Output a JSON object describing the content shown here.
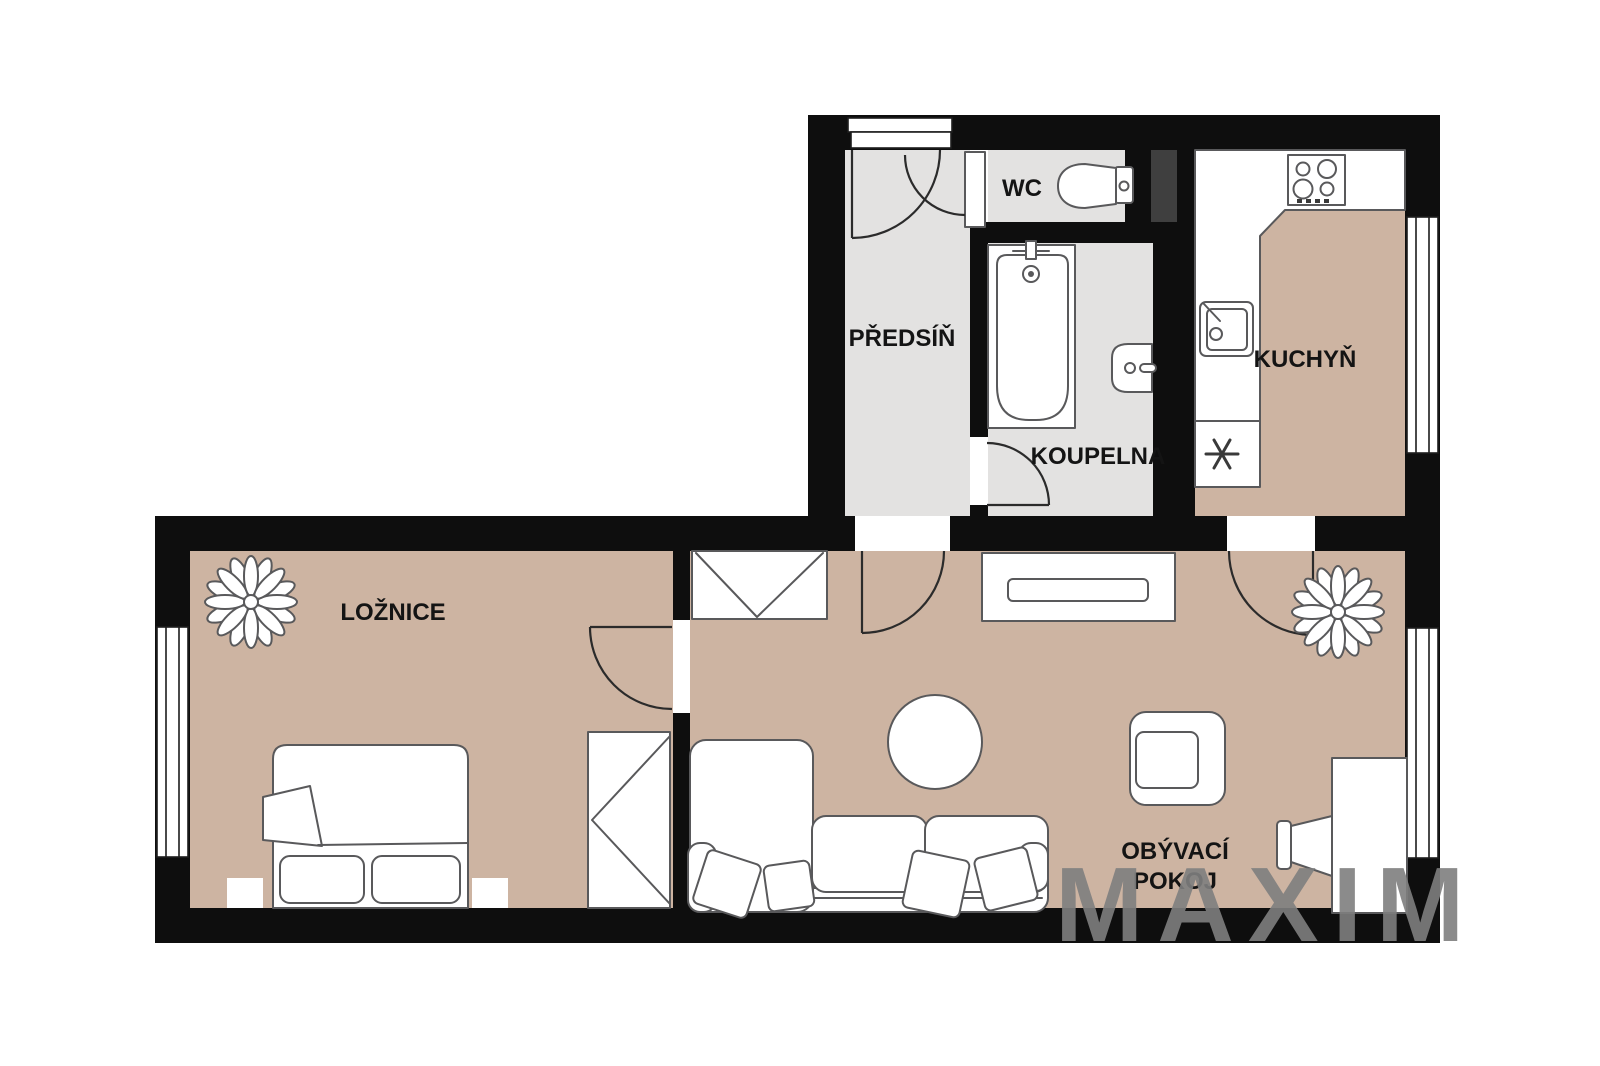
{
  "floorplan": {
    "watermark": "MAXIM",
    "rooms": {
      "hallway": {
        "label": "PŘEDSÍŇ"
      },
      "wc": {
        "label": "WC"
      },
      "bathroom": {
        "label": "KOUPELNA"
      },
      "kitchen": {
        "label": "KUCHYŇ"
      },
      "bedroom": {
        "label": "LOŽNICE"
      },
      "living_room": {
        "label_line1": "OBÝVACÍ",
        "label_line2": "POKOJ"
      }
    },
    "fixtures": [
      "entrance-door",
      "toilet",
      "bathtub",
      "bathroom-sink",
      "stove",
      "kitchen-sink",
      "freezer",
      "bed",
      "nightstand",
      "wardrobe",
      "sofa",
      "chaise",
      "coffee-table",
      "armchair",
      "tv",
      "tv-stand",
      "sideboard",
      "plant",
      "window"
    ],
    "colors": {
      "wall": "#0e0e0e",
      "floor_main": "#cdb4a2",
      "floor_wet": "#e3e2e1",
      "shaft": "#3f3f3f",
      "furn_fill": "#ffffff",
      "furn_stroke": "#59595b",
      "watermark": "#7f7f7f",
      "bg": "#ffffff"
    }
  }
}
